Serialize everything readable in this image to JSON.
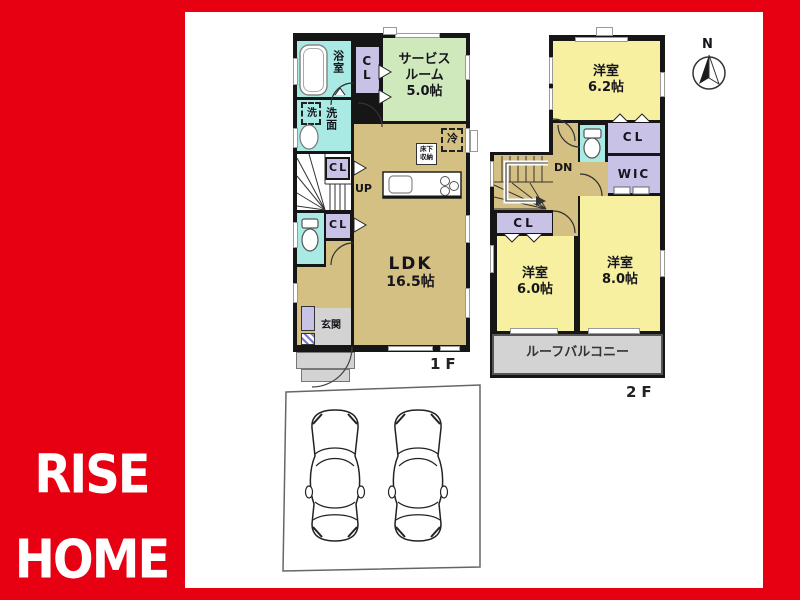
{
  "brand": {
    "line1": "RISE",
    "line2": "HOME"
  },
  "compass": {
    "north": "N"
  },
  "floors": {
    "f1": {
      "label": "1F",
      "bath": "浴室",
      "cl_top": "CL",
      "service": [
        "サービス",
        "ルーム",
        "5.0帖"
      ],
      "laundry": "洗",
      "washroom": "洗面",
      "cl_mid": "CL",
      "up": "UP",
      "cl_low": "CL",
      "ldk": [
        "LDK",
        "16.5帖"
      ],
      "fridge": "冷",
      "underfloor": [
        "床下",
        "収納"
      ],
      "entrance": "玄関"
    },
    "f2": {
      "label": "2F",
      "room_a": [
        "洋室",
        "6.2帖"
      ],
      "dn": "DN",
      "cl_top": "CL",
      "wic": "WIC",
      "cl_low": "CL",
      "room_b": [
        "洋室",
        "6.0帖"
      ],
      "room_c": [
        "洋室",
        "8.0帖"
      ],
      "balcony": "ルーフバルコニー"
    }
  },
  "colors": {
    "brand_red": "#e60012",
    "wall_black": "#161616",
    "room_tan": "#d5c083",
    "room_yellow": "#f6f0a0",
    "room_green": "#cfe9bd",
    "water_cyan": "#a9ebe4",
    "closet_purple": "#c7c2e6",
    "outdoor_gray": "#d3d3d3"
  }
}
